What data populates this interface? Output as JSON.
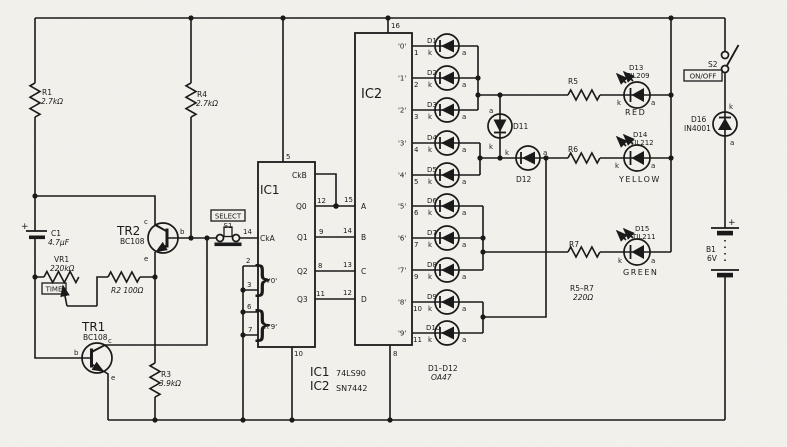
{
  "schematic": {
    "ink": "#1a1a1a",
    "paper": "#f4f2ed",
    "pin": {
      "k": "k",
      "a": "a",
      "b": "b",
      "c": "c",
      "e": "e",
      "plus": "+"
    },
    "r1": {
      "name": "R1",
      "value": "2.7kΩ"
    },
    "r2": {
      "label": "R2 100Ω"
    },
    "r3": {
      "name": "R3",
      "value": "3.9kΩ"
    },
    "r4": {
      "name": "R4",
      "value": "2.7kΩ"
    },
    "r5": {
      "name": "R5"
    },
    "r6": {
      "name": "R6"
    },
    "r7": {
      "name": "R7"
    },
    "r_note": {
      "range": "R5–R7",
      "value": "220Ω"
    },
    "vr1": {
      "name": "VR1",
      "value": "220kΩ",
      "tag": "TIME"
    },
    "c1": {
      "name": "C1",
      "value": "4.7µF"
    },
    "tr1": {
      "name": "TR1",
      "part": "BC108"
    },
    "tr2": {
      "name": "TR2",
      "part": "BC108"
    },
    "s1": {
      "tag": "SELECT",
      "name": "S1"
    },
    "s2": {
      "name": "S2",
      "tag": "ON/OFF"
    },
    "d11": {
      "name": "D11"
    },
    "d12": {
      "name": "D12"
    },
    "d16": {
      "name": "D16",
      "part": "IN4001"
    },
    "b1": {
      "name": "B1",
      "value": "6V"
    },
    "led_red": {
      "name": "D13",
      "part": "TIL209",
      "color": "RED"
    },
    "led_yellow": {
      "name": "D14",
      "part": "TIL212",
      "color": "YELLOW"
    },
    "led_green": {
      "name": "D15",
      "part": "TIL211",
      "color": "GREEN"
    },
    "d_note": {
      "range": "D1–D12",
      "part": "OA47"
    },
    "parts_note": {
      "ic1": "IC1",
      "ic1_part": "74LS90",
      "ic2": "IC2",
      "ic2_part": "SN7442"
    },
    "ic1": {
      "label": "IC1",
      "ckb": "CkB",
      "cka": "CkA",
      "q0": "Q0",
      "q1": "Q1",
      "q2": "Q2",
      "q3": "Q3",
      "p5": "5",
      "p14": "14",
      "p12": "12",
      "p9": "9",
      "p8": "8",
      "p11": "11",
      "p2": "2",
      "p3": "3",
      "p6": "6",
      "p7": "7",
      "p10": "10",
      "r0": "R'0'",
      "r9": "R'9'",
      "brace": "}"
    },
    "ic2": {
      "label": "IC2",
      "p16": "16",
      "p8": "8",
      "inputs": [
        {
          "pin": "15",
          "name": "A"
        },
        {
          "pin": "14",
          "name": "B"
        },
        {
          "pin": "13",
          "name": "C"
        },
        {
          "pin": "12",
          "name": "D"
        }
      ],
      "outputs": [
        {
          "pin": "1",
          "name": "'0'"
        },
        {
          "pin": "2",
          "name": "'1'"
        },
        {
          "pin": "3",
          "name": "'2'"
        },
        {
          "pin": "4",
          "name": "'3'"
        },
        {
          "pin": "5",
          "name": "'4'"
        },
        {
          "pin": "6",
          "name": "'5'"
        },
        {
          "pin": "7",
          "name": "'6'"
        },
        {
          "pin": "9",
          "name": "'7'"
        },
        {
          "pin": "10",
          "name": "'8'"
        },
        {
          "pin": "11",
          "name": "'9'"
        }
      ]
    },
    "diodes": [
      "D1",
      "D2",
      "D3",
      "D4",
      "D5",
      "D6",
      "D7",
      "D8",
      "D9",
      "D10"
    ]
  }
}
